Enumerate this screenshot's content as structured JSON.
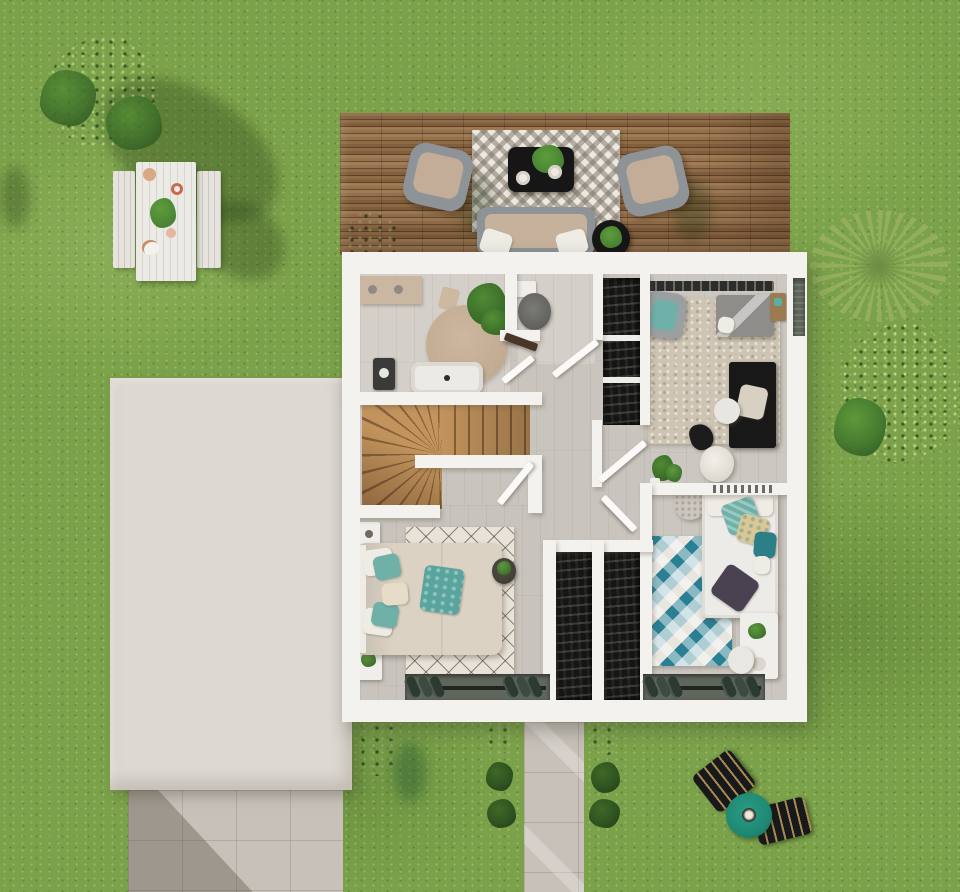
{
  "scene": {
    "kind": "3d-rendered-top-down-floor-plan",
    "level": "upper-floor-with-garden",
    "visible_text": "none"
  },
  "palette": {
    "grass": "#7ba24a",
    "grass_light": "#a3c06b",
    "grass_dark": "#567f33",
    "tree_dark": "#2c5220",
    "tree_mid": "#3f6f2b",
    "tree_light": "#558b33",
    "bush_bright": "#5d9a33",
    "palm_green": "#96af5f",
    "deck_wood": "#8d6945",
    "rug_chevron_bg": "#ece8e0",
    "black_furniture": "#161616",
    "armchair_gray": "#8d9397",
    "cushion_beige": "#c3ad98",
    "sofa_seat": "#c6b19c",
    "roof_white": "#dcd8d2",
    "wall_white": "#f4f2ee",
    "floor_gray": "#c9c5be",
    "floor_light": "#d4d0c9",
    "stair_light": "#c2935c",
    "stair_dark": "#86603a",
    "rug_round": "#c2ab93",
    "rug_tr": "#cec4b3",
    "rug_master": "#e9e3d7",
    "teal_accent": "#2a7f93",
    "rug_kids_light": "#aeced4",
    "duvet_master": "#dbd2c4",
    "pillow_white": "#efece5",
    "cushion_teal": "#6fb0a8",
    "cushion_dark_teal": "#2c7f86",
    "cushion_sand": "#d9c894",
    "cushion_purple": "#4a4250",
    "bed_kids": "#edebe7",
    "bed_guest": "#8e8d8a",
    "closet_black": "#151513",
    "door_brown": "#4a3628",
    "pave_tile": "#c7c1b9",
    "pave_shadow": "rgba(75,66,52,0.33)",
    "window_dark": "#5f665c",
    "slat_dark": "#2c3a31",
    "umbrella_teal": "#1f8a74",
    "lounger_black": "#17191b",
    "lounger_stripe": "#a8894f",
    "plant_green": "#3f7a2e",
    "plant_light": "#5f9c3c",
    "shadow_soft": "rgba(28,48,14,0.3)"
  },
  "inventory": {
    "garden": [
      "tree",
      "picnic-table-set",
      "palm-plant",
      "shrub",
      "path-bushes",
      "sun-loungers",
      "parasol-table",
      "driveway",
      "garden-path"
    ],
    "terrace": [
      "wood-deck",
      "chevron-rug",
      "two-armchairs",
      "black-coffee-table",
      "sofa",
      "round-side-table",
      "potted-plant"
    ],
    "bathroom": [
      "vanity-counter",
      "washing-machine",
      "bathtub",
      "round-rug",
      "plant",
      "towel"
    ],
    "wc": [
      "toilet"
    ],
    "guest-bedroom": [
      "open-wardrobe",
      "clothes-rail",
      "area-rug",
      "armchair",
      "single-bed",
      "nightstand",
      "black-desk",
      "desk-chair",
      "bag"
    ],
    "hall": [
      "staircase",
      "winder-stairs",
      "doors",
      "plants",
      "pouf"
    ],
    "master-bedroom": [
      "double-bed",
      "diamond-rug",
      "nightstands",
      "plant-table",
      "sliding-window-shutters"
    ],
    "kids-bedroom": [
      "white-bed",
      "cube-pattern-rug",
      "pouf",
      "desk",
      "desk-chair",
      "closet-columns"
    ]
  }
}
